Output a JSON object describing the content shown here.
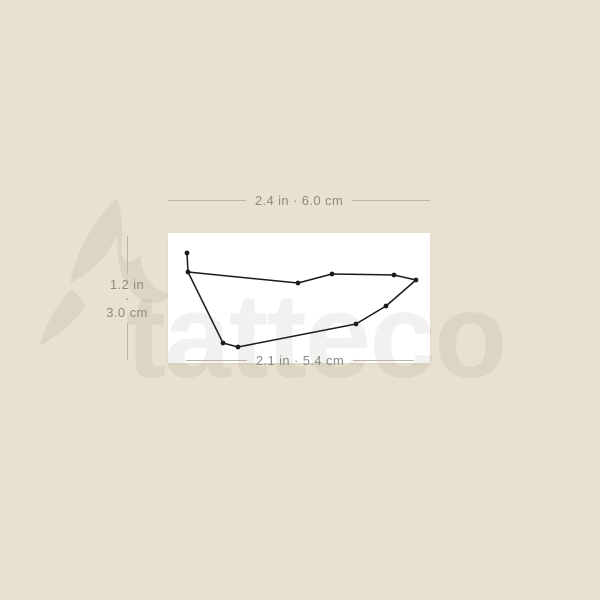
{
  "page": {
    "background_color": "#e8e1cf"
  },
  "watermark": {
    "text": "tatteco",
    "color": "rgba(90,80,58,0.08)",
    "icon": "hummingbird-icon"
  },
  "card": {
    "background_color": "#ffffff"
  },
  "measurements": {
    "text_color": "#8b8a84",
    "line_color": "#bab5a8",
    "top": {
      "label": "2.4 in · 6.0 cm"
    },
    "left": {
      "inches": "1.2 in",
      "separator": "·",
      "centimeters": "3.0 cm"
    },
    "bottom": {
      "label": "2.1 in · 5.4 cm"
    }
  },
  "constellation": {
    "name": "Capricornus",
    "color": "#1b1b1b",
    "dot_radius": 2.4,
    "line_width": 1.5,
    "canvas": [
      262,
      130
    ],
    "stars": [
      [
        19,
        20
      ],
      [
        20,
        39
      ],
      [
        130,
        50
      ],
      [
        164,
        41
      ],
      [
        226,
        42
      ],
      [
        248,
        47
      ],
      [
        218,
        73
      ],
      [
        188,
        91
      ],
      [
        70,
        114
      ],
      [
        55,
        110
      ]
    ],
    "edges": [
      [
        0,
        1
      ],
      [
        1,
        2
      ],
      [
        2,
        3
      ],
      [
        3,
        4
      ],
      [
        4,
        5
      ],
      [
        5,
        6
      ],
      [
        6,
        7
      ],
      [
        7,
        8
      ],
      [
        8,
        9
      ],
      [
        9,
        1
      ]
    ]
  }
}
